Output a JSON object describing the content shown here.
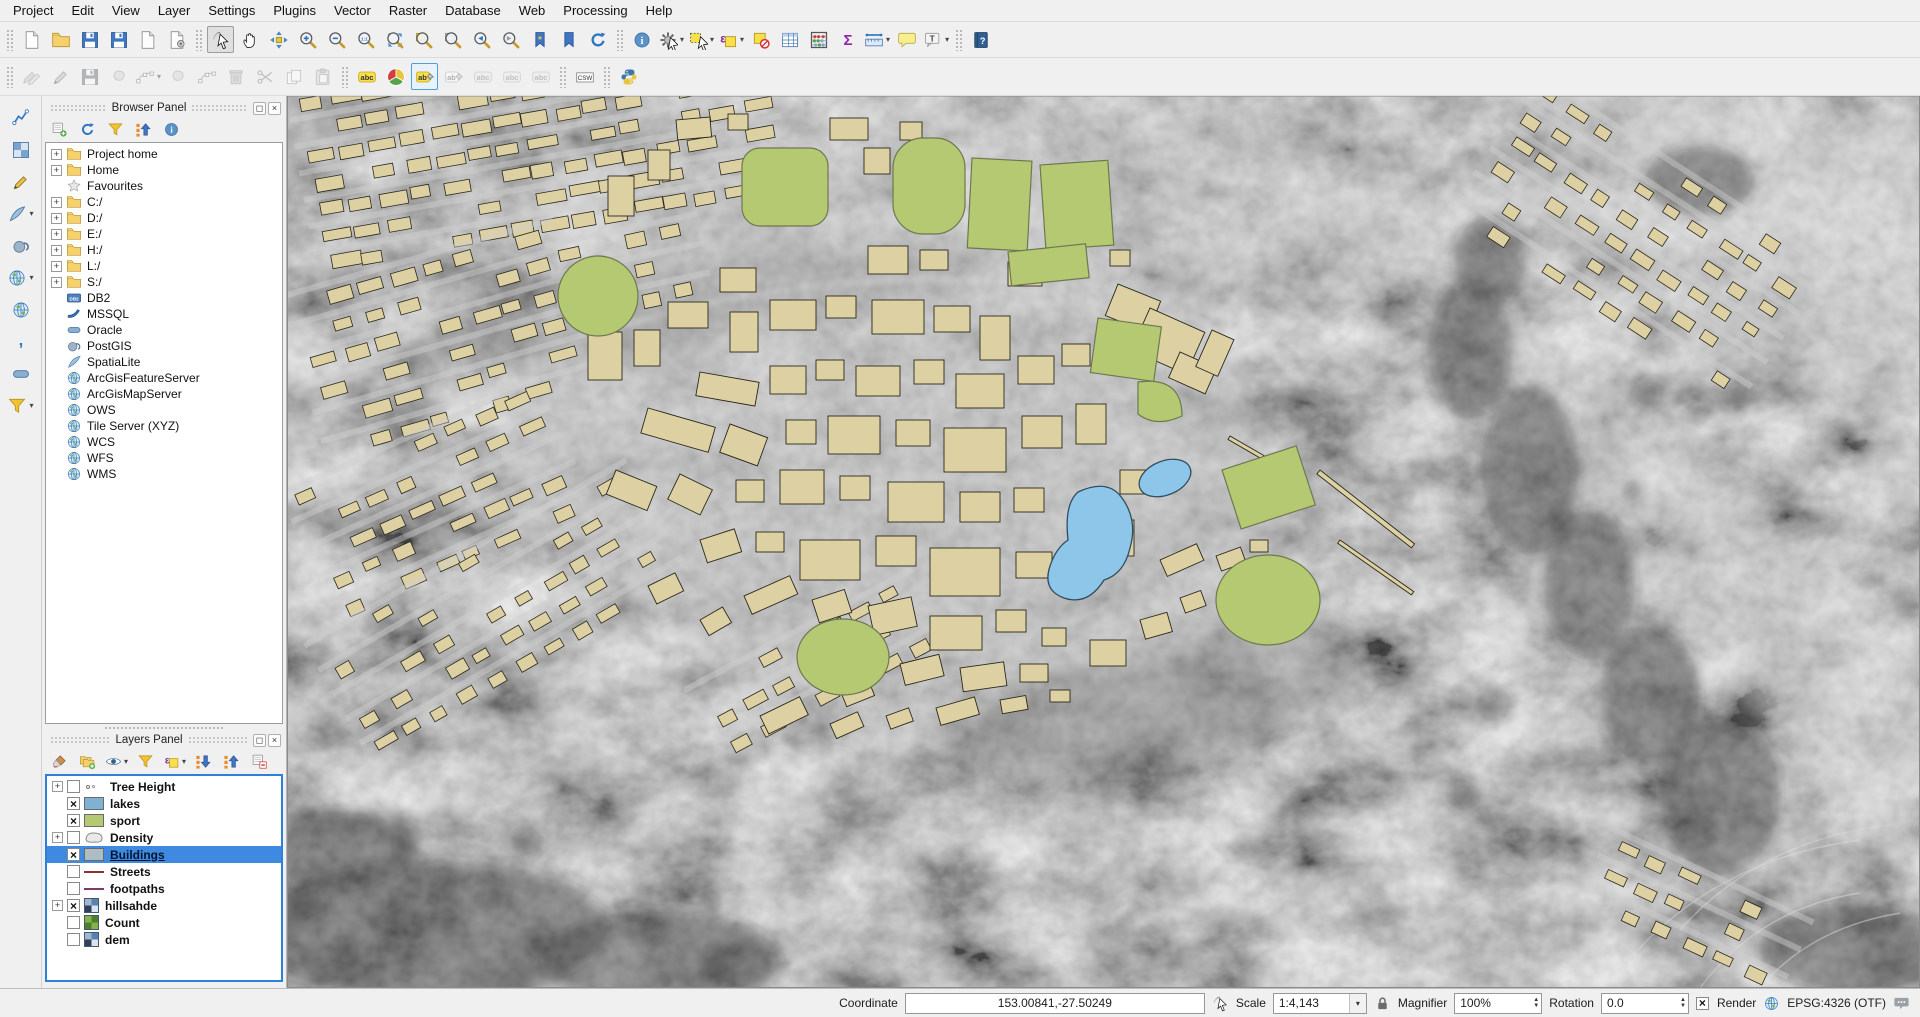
{
  "menu": {
    "items": [
      "Project",
      "Edit",
      "View",
      "Layer",
      "Settings",
      "Plugins",
      "Vector",
      "Raster",
      "Database",
      "Web",
      "Processing",
      "Help"
    ]
  },
  "icon_glyphs": {
    "abc": "abc",
    "ab": "ab",
    "csw": "CSW",
    "db2": "DB2",
    "sigma": "Σ",
    "epsilon": "ε",
    "info": "i",
    "help": "?",
    "native": "1:1",
    "t": "T",
    "star": "★",
    "comma": ",",
    "v": "V"
  },
  "colors": {
    "accent_selection": "#3d8ae0",
    "building_fill": "#ddd1a4",
    "building_stroke": "#2a281c",
    "sport_fill": "#b5c973",
    "sport_stroke": "#6e7850",
    "lake_fill": "#8dc6e8",
    "lake_stroke": "#2f4d5e",
    "lakes_swatch": "#7fb2d2",
    "sport_swatch": "#b5c973",
    "buildings_swatch": "#aebcc4",
    "streets_swatch": "#8c3032",
    "footpaths_swatch": "#7c3c63"
  },
  "toolbars": {
    "main": [
      {
        "group": "project",
        "items": [
          {
            "name": "new-project",
            "icon": "file"
          },
          {
            "name": "open-project",
            "icon": "folder"
          },
          {
            "name": "save-project",
            "icon": "floppy"
          },
          {
            "name": "save-project-as",
            "icon": "floppy"
          },
          {
            "name": "new-print-composer",
            "icon": "file"
          },
          {
            "name": "composer-manager",
            "icon": "filegear"
          }
        ]
      },
      {
        "group": "map-navigation",
        "items": [
          {
            "name": "touch-zoom-and-pan",
            "icon": "touch",
            "active": true
          },
          {
            "name": "pan-map",
            "icon": "hand"
          },
          {
            "name": "pan-to-selection",
            "icon": "move"
          },
          {
            "name": "zoom-in",
            "icon": "zin"
          },
          {
            "name": "zoom-out",
            "icon": "zout"
          },
          {
            "name": "zoom-native",
            "icon": "z11"
          },
          {
            "name": "zoom-full",
            "icon": "zfull"
          },
          {
            "name": "zoom-to-selection",
            "icon": "zsel"
          },
          {
            "name": "zoom-to-layer",
            "icon": "zlayer"
          },
          {
            "name": "zoom-last",
            "icon": "zlast"
          },
          {
            "name": "zoom-next",
            "icon": "znext"
          },
          {
            "name": "new-bookmark",
            "icon": "bookmarknew"
          },
          {
            "name": "show-bookmarks",
            "icon": "bookmark"
          },
          {
            "name": "refresh-map",
            "icon": "refresh"
          }
        ]
      },
      {
        "group": "attributes",
        "items": [
          {
            "name": "identify-features",
            "icon": "info"
          },
          {
            "name": "run-feature-action",
            "icon": "gear",
            "dd": true
          },
          {
            "name": "select-features",
            "icon": "selrect",
            "dd": true
          },
          {
            "name": "select-by-expression",
            "icon": "selexpr",
            "dd": true
          },
          {
            "name": "deselect-all",
            "icon": "desel"
          },
          {
            "name": "open-attribute-table",
            "icon": "attrtable"
          },
          {
            "name": "field-calculator",
            "icon": "abacus"
          },
          {
            "name": "statistical-summary",
            "icon": "sigma"
          },
          {
            "name": "measure",
            "icon": "ruler",
            "dd": true
          },
          {
            "name": "map-tips",
            "icon": "bubble"
          },
          {
            "name": "text-annotation",
            "icon": "textT",
            "dd": true
          }
        ]
      },
      {
        "group": "help",
        "items": [
          {
            "name": "help-contents",
            "icon": "help"
          }
        ]
      }
    ],
    "edit": [
      {
        "group": "digitizing",
        "items": [
          {
            "name": "current-edits",
            "icon": "pencils",
            "disabled": true
          },
          {
            "name": "toggle-editing",
            "icon": "pencil",
            "disabled": true
          },
          {
            "name": "save-layer-edits",
            "icon": "floppy",
            "disabled": true
          },
          {
            "name": "add-feature",
            "icon": "blob",
            "disabled": true
          },
          {
            "name": "node-tool",
            "icon": "node",
            "disabled": true,
            "dd": true
          },
          {
            "name": "move-feature",
            "icon": "blob",
            "disabled": true
          },
          {
            "name": "rotate-feature",
            "icon": "node",
            "disabled": true
          },
          {
            "name": "delete-selected",
            "icon": "trash",
            "disabled": true
          },
          {
            "name": "cut-features",
            "icon": "scissors",
            "disabled": true
          },
          {
            "name": "copy-features",
            "icon": "copy",
            "disabled": true
          },
          {
            "name": "paste-features",
            "icon": "paste",
            "disabled": true
          }
        ]
      },
      {
        "group": "labels",
        "items": [
          {
            "name": "layer-labeling-options",
            "icon": "abcY"
          },
          {
            "name": "layer-diagram-options",
            "icon": "pie"
          },
          {
            "name": "pin-unpin-labels",
            "icon": "abPinY",
            "selactive": true
          },
          {
            "name": "highlight-pinned-labels",
            "icon": "abPin",
            "disabled": true
          },
          {
            "name": "move-label",
            "icon": "abcG",
            "disabled": true
          },
          {
            "name": "rotate-label",
            "icon": "abcG",
            "disabled": true
          },
          {
            "name": "change-label",
            "icon": "abcG",
            "disabled": true
          }
        ]
      },
      {
        "group": "metasearch",
        "items": [
          {
            "name": "metasearch-csw",
            "icon": "csw"
          }
        ]
      },
      {
        "group": "python",
        "items": [
          {
            "name": "python-console",
            "icon": "python"
          }
        ]
      }
    ],
    "left": [
      {
        "group": "manage-layers",
        "items": [
          {
            "name": "add-vector-layer",
            "icon": "vec"
          },
          {
            "name": "add-raster-layer",
            "icon": "ras"
          },
          {
            "name": "new-shapefile-layer",
            "icon": "pencil"
          },
          {
            "name": "add-spatialite-layer",
            "icon": "spatialite",
            "dd": true
          },
          {
            "name": "add-postgis-layer",
            "icon": "postgis"
          },
          {
            "name": "add-wms-layer",
            "icon": "globe",
            "dd": true
          },
          {
            "name": "add-wfs-layer",
            "icon": "globe"
          },
          {
            "name": "add-delimited-text-layer",
            "icon": "comma"
          },
          {
            "name": "add-oracle-layer",
            "icon": "oracle"
          },
          {
            "name": "add-virtual-layer",
            "icon": "funnel",
            "dd": true
          }
        ]
      }
    ],
    "browser": [
      {
        "group": "browser-tools",
        "items": [
          {
            "name": "add-selected-layers",
            "icon": "addlayer"
          },
          {
            "name": "refresh-browser",
            "icon": "refresh"
          },
          {
            "name": "filter-browser",
            "icon": "funnel"
          },
          {
            "name": "collapse-all",
            "icon": "treeup"
          },
          {
            "name": "enable-properties-widget",
            "icon": "info"
          }
        ]
      }
    ],
    "layers": [
      {
        "group": "layers-tools",
        "items": [
          {
            "name": "open-layer-styling-dock",
            "icon": "brush"
          },
          {
            "name": "add-group",
            "icon": "addgroup"
          },
          {
            "name": "manage-map-themes",
            "icon": "eye",
            "dd": true
          },
          {
            "name": "filter-legend",
            "icon": "funnel"
          },
          {
            "name": "filter-legend-by-expression",
            "icon": "selexpr",
            "dd": true
          },
          {
            "name": "expand-all",
            "icon": "treedown"
          },
          {
            "name": "collapse-all-layers",
            "icon": "treeup"
          },
          {
            "name": "remove-layer-group",
            "icon": "removelayer"
          }
        ]
      }
    ]
  },
  "browser_panel": {
    "title": "Browser Panel",
    "items": [
      {
        "label": "Project home",
        "icon": "folder",
        "exp": true
      },
      {
        "label": "Home",
        "icon": "folder",
        "exp": true
      },
      {
        "label": "Favourites",
        "icon": "star",
        "exp": false
      },
      {
        "label": "C:/",
        "icon": "folder",
        "exp": true
      },
      {
        "label": "D:/",
        "icon": "folder",
        "exp": true
      },
      {
        "label": "E:/",
        "icon": "folder",
        "exp": true
      },
      {
        "label": "H:/",
        "icon": "folder",
        "exp": true
      },
      {
        "label": "L:/",
        "icon": "folder",
        "exp": true
      },
      {
        "label": "S:/",
        "icon": "folder",
        "exp": true
      },
      {
        "label": "DB2",
        "icon": "db2",
        "exp": false
      },
      {
        "label": "MSSQL",
        "icon": "mssql",
        "exp": false
      },
      {
        "label": "Oracle",
        "icon": "oracle",
        "exp": false
      },
      {
        "label": "PostGIS",
        "icon": "postgis",
        "exp": false
      },
      {
        "label": "SpatiaLite",
        "icon": "spatialite",
        "exp": false
      },
      {
        "label": "ArcGisFeatureServer",
        "icon": "globe",
        "exp": false
      },
      {
        "label": "ArcGisMapServer",
        "icon": "globe",
        "exp": false
      },
      {
        "label": "OWS",
        "icon": "globe",
        "exp": false
      },
      {
        "label": "Tile Server (XYZ)",
        "icon": "globe",
        "exp": false
      },
      {
        "label": "WCS",
        "icon": "globe",
        "exp": false
      },
      {
        "label": "WFS",
        "icon": "globe",
        "exp": false
      },
      {
        "label": "WMS",
        "icon": "globe",
        "exp": false
      }
    ]
  },
  "layers_panel": {
    "title": "Layers Panel",
    "layers": [
      {
        "name": "Tree Height",
        "exp": true,
        "checked": false,
        "swatch": "marker"
      },
      {
        "name": "lakes",
        "exp": false,
        "checked": true,
        "swatch": "fill-lakes"
      },
      {
        "name": "sport",
        "exp": false,
        "checked": true,
        "swatch": "fill-sport"
      },
      {
        "name": "Density",
        "exp": true,
        "checked": false,
        "swatch": "poly"
      },
      {
        "name": "Buildings",
        "exp": false,
        "checked": true,
        "swatch": "fill-buildings",
        "selected": true
      },
      {
        "name": "Streets",
        "exp": false,
        "checked": false,
        "swatch": "line-streets"
      },
      {
        "name": "footpaths",
        "exp": false,
        "checked": false,
        "swatch": "line-footpaths"
      },
      {
        "name": "hillsahde",
        "exp": true,
        "checked": true,
        "swatch": "raster-blue"
      },
      {
        "name": "Count",
        "exp": false,
        "checked": false,
        "swatch": "raster-green"
      },
      {
        "name": "dem",
        "exp": false,
        "checked": false,
        "swatch": "raster-blue"
      }
    ]
  },
  "statusbar": {
    "coordinate_label": "Coordinate",
    "coordinate_value": "153.00841,-27.50249",
    "scale_label": "Scale",
    "scale_value": "1:4,143",
    "magnifier_label": "Magnifier",
    "magnifier_value": "100%",
    "rotation_label": "Rotation",
    "rotation_value": "0.0",
    "render_label": "Render",
    "render_checked": true,
    "crs": "EPSG:4326 (OTF)"
  }
}
